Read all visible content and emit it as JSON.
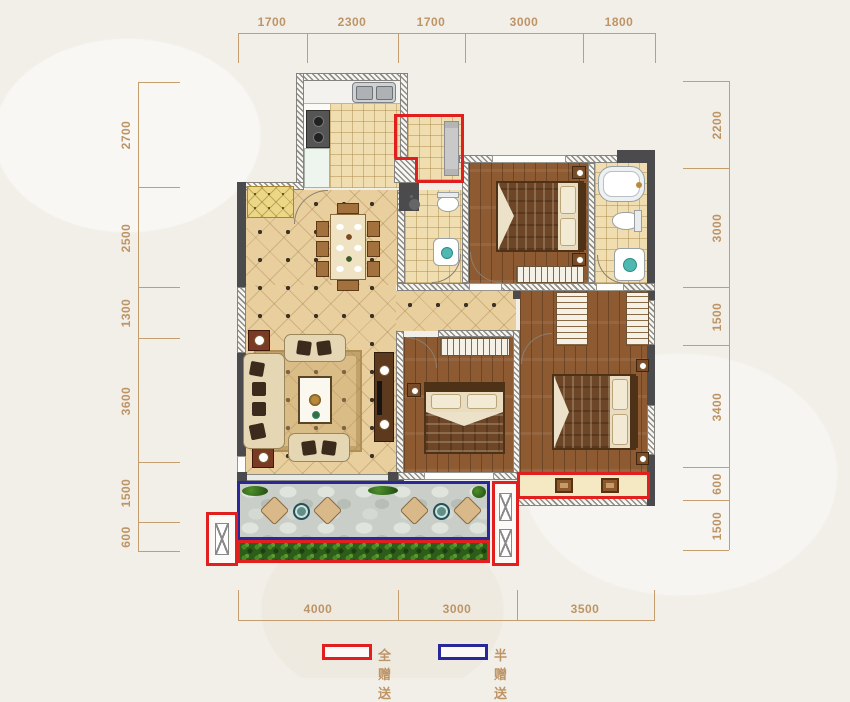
{
  "dimensions": {
    "top": [
      "1700",
      "2300",
      "1700",
      "3000",
      "1800"
    ],
    "left": [
      "2700",
      "2500",
      "1300",
      "3600",
      "1500",
      "600"
    ],
    "right": [
      "2200",
      "3000",
      "1500",
      "3400",
      "600",
      "1500"
    ],
    "bottom": [
      "4000",
      "3000",
      "3500"
    ]
  },
  "legend": {
    "full_gift": {
      "label": "全赠送",
      "color": "#e11f1f"
    },
    "half_gift": {
      "label": "半赠送",
      "color": "#28289a"
    }
  },
  "palette": {
    "dimension_text": "#bd9466",
    "wall_dark": "#4b4b4d",
    "wood_floor": "#8d5a32",
    "tile_floor": "#f0deb0",
    "diamond_tile_floor": "#e9cf9e",
    "balcony_stone": "#c9cfc8",
    "hedge_green": "#2c5e1a"
  }
}
